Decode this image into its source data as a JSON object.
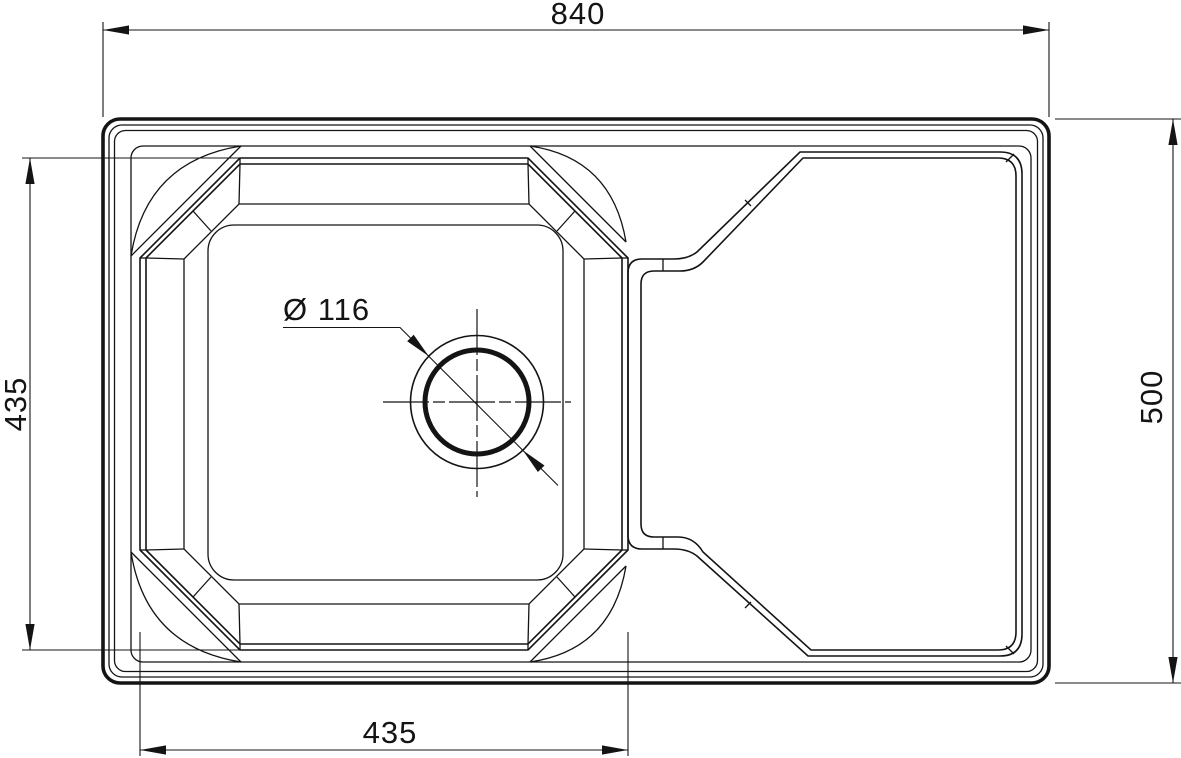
{
  "drawing": {
    "type": "technical-drawing",
    "subject": "kitchen sink with drainer, top view",
    "units": "mm",
    "dimensions": {
      "overall_width": "840",
      "overall_depth": "500",
      "bowl_width": "435",
      "bowl_depth": "435",
      "drain_diameter": "Ø 116"
    },
    "colors": {
      "line": "#141414",
      "background": "#ffffff"
    }
  }
}
